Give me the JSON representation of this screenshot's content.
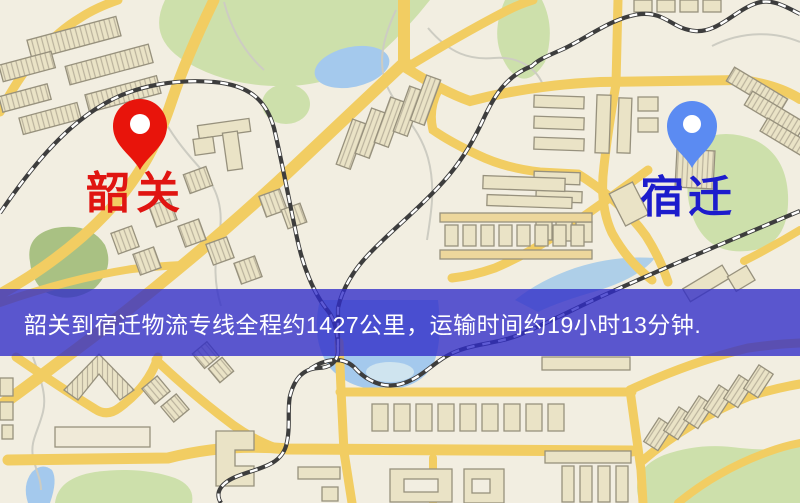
{
  "map": {
    "origin": {
      "name": "韶关",
      "pin_color": "#e8140b",
      "label_color": "#e01511"
    },
    "destination": {
      "name": "宿迁",
      "pin_color": "#5b8bf2",
      "label_color": "#1c1ccc"
    },
    "banner": {
      "text": "韶关到宿迁物流专线全程约1427公里，运输时间约19小时13分钟.",
      "background": "rgba(47,44,200,0.78)",
      "text_color": "#ffffff"
    },
    "palette": {
      "background": "#f2eee1",
      "road": "#f2cd62",
      "water": "#a4c9ed",
      "green": "#cde0ab",
      "green_dark": "#a9c183",
      "building": "#eae3c6",
      "building_stroke": "#97917d",
      "railway": "#3d3d3d"
    }
  }
}
